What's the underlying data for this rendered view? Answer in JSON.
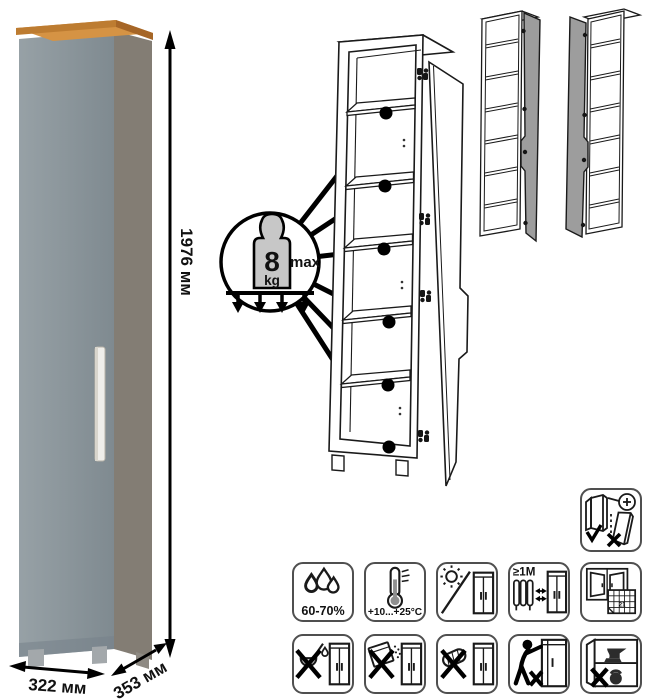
{
  "product": {
    "dimensions": {
      "height": "1976 мм",
      "width": "322 мм",
      "depth": "353 мм"
    },
    "load_badge": {
      "value": "8",
      "unit": "kg",
      "qualifier": "max"
    }
  },
  "care_icons": {
    "humidity": "60-70%",
    "temperature": "+10...+25°C",
    "min_distance": "≥1М",
    "calendar_day": "21"
  },
  "colors": {
    "door_front": "#8a949a",
    "side_panel": "#837d74",
    "wood_top": "#c9883f",
    "line": "#1a1a1a"
  }
}
